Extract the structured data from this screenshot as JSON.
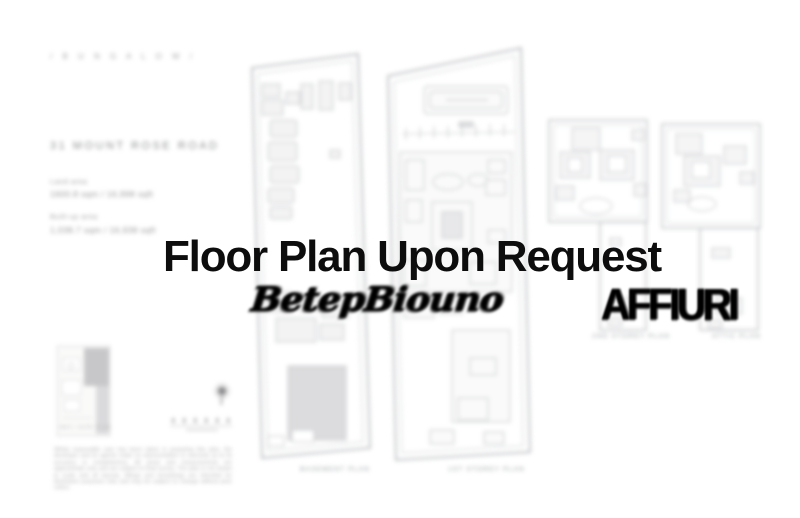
{
  "page": {
    "background": "#ffffff",
    "accent_text_color": "#0d0d0d",
    "plan_line_color": "#c6c8cb"
  },
  "left_panel": {
    "category": "/  B U N G A L O W  /",
    "address": "31 MOUNT ROSE ROAD",
    "land_area_label": "Land area",
    "land_area_value": "1600.8 sqm / 16,998 sqft",
    "built_up_label": "Built-up area",
    "built_up_value": "1,038.7 sqm / 16,938 sqft",
    "site_thumb_caption": "KEY / SITE PLAN",
    "disclaimer": "Whilst reasonable care has been taken in preparing this plan, the developer and its agents make no representation or warranty as to its accuracy or completeness. All areas and measurements are approximate only and are subject to final survey. The plan is not drawn to scale and all layouts, fittings and furnishings are intended for illustration purposes only and may be subject to change without prior notice."
  },
  "plans": {
    "captions": [
      {
        "label": "BASEMENT PLAN"
      },
      {
        "label": "1ST STOREY PLAN"
      },
      {
        "label": "2ND STOREY PLAN"
      },
      {
        "label": "ATTIC PLAN"
      }
    ]
  },
  "overlay": {
    "title": "Floor Plan Upon Request",
    "scribble_text": "BetepBiouno",
    "watermark": "AFFIURI"
  }
}
